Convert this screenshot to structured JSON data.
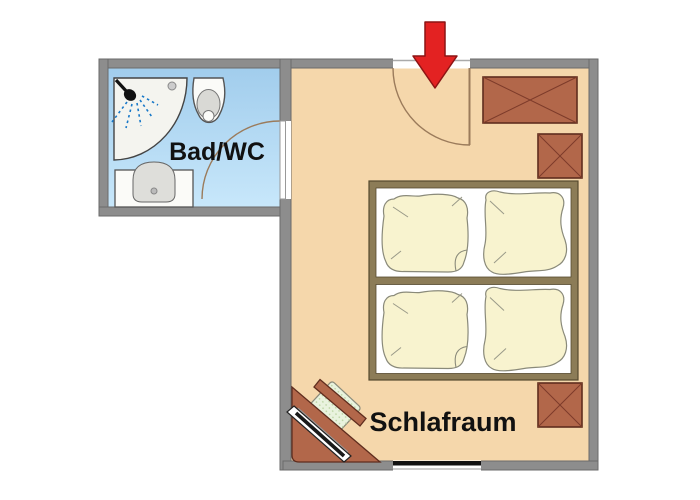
{
  "rooms": {
    "bathroom": {
      "label": "Bad/WC"
    },
    "bedroom": {
      "label": "Schlafraum"
    }
  },
  "colors": {
    "wall": "#8d8d8d",
    "wall_edge": "#6a6a6a",
    "bathroom_floor_top": "#a0ccec",
    "bathroom_floor_bottom": "#c9e8fb",
    "bedroom_floor": "#f5d7ab",
    "wardrobe": "#b2674a",
    "wardrobe_edge": "#5f2d1e",
    "bed_frame": "#8c7c57",
    "bed_interior": "#ffffff",
    "bedding": "#f8f3cf",
    "bedding_edge": "#8a8a7a",
    "fixture": "#fbfbf8",
    "fixture_edge": "#555555",
    "spray_blue": "#1878c8",
    "chair": "#e9f3de",
    "arrow_red": "#e32222",
    "window_black": "#111111",
    "door_line": "#9b7b5b"
  },
  "elements": {
    "entrance_arrow": "entrance-arrow",
    "entry_door": "entry-door",
    "bathroom_door": "bathroom-door",
    "shower": "shower",
    "toilet": "toilet",
    "sink": "sink",
    "wardrobe_large": "wardrobe-large",
    "wardrobe_small_top": "wardrobe-small-top",
    "wardrobe_small_bottom": "wardrobe-small-bottom",
    "double_bed": "double-bed",
    "window": "window",
    "corner_desk": "corner-desk",
    "chair": "chair"
  }
}
